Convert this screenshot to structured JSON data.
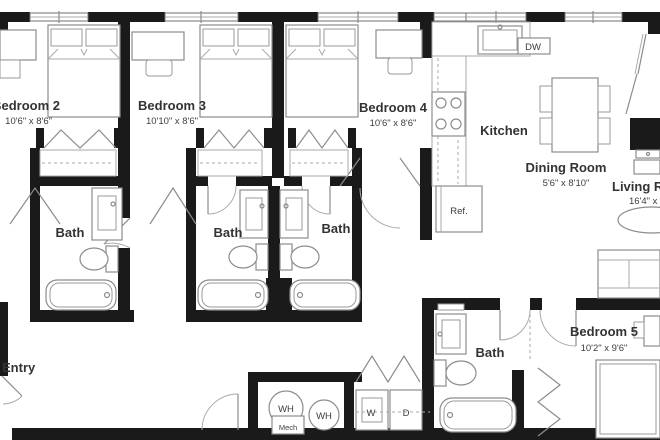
{
  "floor_plan": {
    "rooms": {
      "bedroom2": {
        "label": "Bedroom 2",
        "dims": "10'6\" x 8'6\""
      },
      "bedroom3": {
        "label": "Bedroom 3",
        "dims": "10'10\" x 8'6\""
      },
      "bedroom4": {
        "label": "Bedroom 4",
        "dims": "10'6\" x 8'6\""
      },
      "bedroom5": {
        "label": "Bedroom 5",
        "dims": "10'2\" x 9'6\""
      },
      "kitchen": {
        "label": "Kitchen"
      },
      "dining_room": {
        "label": "Dining Room",
        "dims": "5'6\" x 8'10\""
      },
      "living_room": {
        "label": "Living Room",
        "dims": "16'4\" x 1"
      },
      "bath1": {
        "label": "Bath"
      },
      "bath2": {
        "label": "Bath"
      },
      "bath3": {
        "label": "Bath"
      },
      "bath4": {
        "label": "Bath"
      },
      "entry": {
        "label": "Entry"
      }
    },
    "fixtures": {
      "dishwasher": "DW",
      "refrigerator": "Ref.",
      "water_heater_1": "WH",
      "water_heater_2": "WH",
      "mechanical": "Mech",
      "washer": "W",
      "dryer": "D"
    },
    "colors": {
      "wall": "#1a1a1a",
      "furniture_line": "#8c8c8c",
      "text": "#333333",
      "background": "#ffffff"
    }
  }
}
